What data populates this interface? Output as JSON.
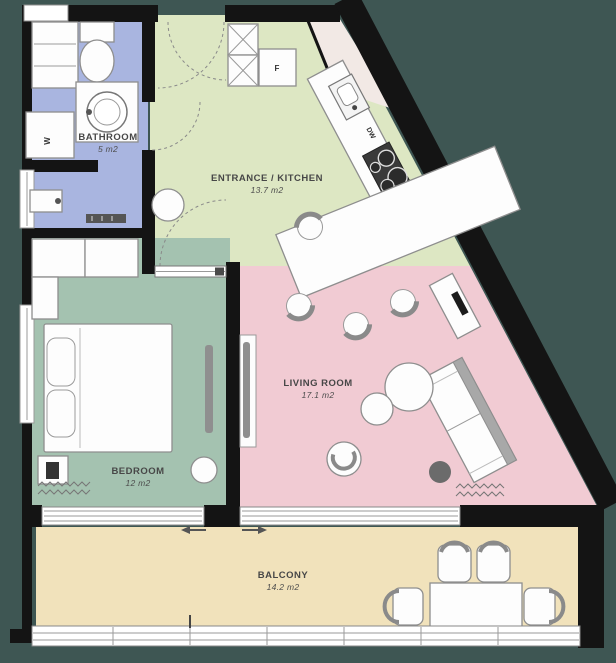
{
  "title": "Apartment floor plan",
  "rooms": {
    "bathroom": {
      "name": "BATHROOM",
      "area": "5 m2"
    },
    "kitchen": {
      "name": "ENTRANCE / KITCHEN",
      "area": "13.7 m2"
    },
    "living": {
      "name": "LIVING ROOM",
      "area": "17.1 m2"
    },
    "bedroom": {
      "name": "BEDROOM",
      "area": "12 m2"
    },
    "balcony": {
      "name": "BALCONY",
      "area": "14.2 m2"
    }
  },
  "appliances": {
    "washing_machine": "W",
    "fridge": "F",
    "dishwasher": "DW"
  },
  "colors": {
    "background": "#3E5653",
    "bathroom": "#A9B5E0",
    "kitchen": "#DDE7C3",
    "living": "#F1CBD3",
    "bedroom": "#A4C2B0",
    "balcony": "#F1E2BB",
    "walls": "#141414"
  }
}
